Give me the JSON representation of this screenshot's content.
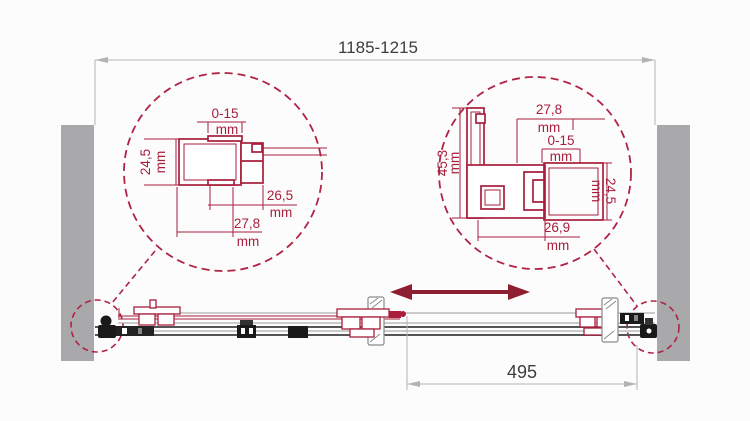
{
  "diagram": {
    "overall_width_label": "1185-1215",
    "slide_width_label": "495",
    "left_section": {
      "adjustment": "0-15",
      "adjustment_unit": "mm",
      "profile_height": "24,5",
      "profile_height_unit": "mm",
      "inner_width": "26,5",
      "inner_width_unit": "mm",
      "outer_width": "27,8",
      "outer_width_unit": "mm"
    },
    "right_section": {
      "outer_width": "27,8",
      "outer_width_unit": "mm",
      "adjustment": "0-15",
      "adjustment_unit": "mm",
      "profile_height": "45,3",
      "profile_height_unit": "mm",
      "door_profile_height": "24,5",
      "door_profile_height_unit": "mm",
      "inner_width": "26,9",
      "inner_width_unit": "mm"
    },
    "colors": {
      "detail_crimson": "#a81e3c",
      "dash_crimson": "#b02344",
      "arrow_red": "#8e1f33",
      "wall_gray": "#a9a9ac",
      "dimension_gray": "#b3b3b3",
      "text_dark": "#3d3d3d",
      "fitting_black": "#1a1a1a"
    }
  }
}
